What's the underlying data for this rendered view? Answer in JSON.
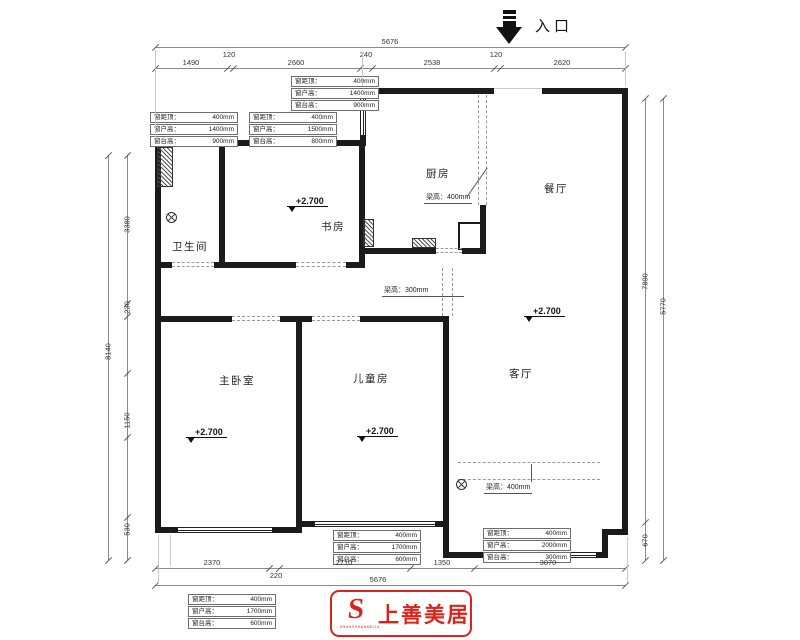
{
  "entrance": {
    "label": "入口"
  },
  "rooms": {
    "bathroom": "卫生间",
    "study": "书房",
    "kitchen": "厨房",
    "dining": "餐厅",
    "master": "主卧室",
    "kids": "儿童房",
    "living": "客厅"
  },
  "level_mark": "+2.700",
  "beams": [
    "梁高：400mm",
    "梁高：300mm",
    "梁高：400mm"
  ],
  "window_boxes": [
    {
      "rows": [
        {
          "k": "窗距顶：",
          "v": "400mm"
        },
        {
          "k": "窗户高：",
          "v": "1400mm"
        },
        {
          "k": "窗台高：",
          "v": "900mm"
        }
      ]
    },
    {
      "rows": [
        {
          "k": "窗距顶：",
          "v": "400mm"
        },
        {
          "k": "窗户高：",
          "v": "1400mm"
        },
        {
          "k": "窗台高：",
          "v": "900mm"
        }
      ]
    },
    {
      "rows": [
        {
          "k": "窗距顶：",
          "v": "400mm"
        },
        {
          "k": "窗户高：",
          "v": "1500mm"
        },
        {
          "k": "窗台高：",
          "v": "800mm"
        }
      ]
    },
    {
      "rows": [
        {
          "k": "窗距顶：",
          "v": "400mm"
        },
        {
          "k": "窗户高：",
          "v": "1700mm"
        },
        {
          "k": "窗台高：",
          "v": "600mm"
        }
      ]
    },
    {
      "rows": [
        {
          "k": "窗距顶：",
          "v": "400mm"
        },
        {
          "k": "窗户高：",
          "v": "2000mm"
        },
        {
          "k": "窗台高：",
          "v": "300mm"
        }
      ]
    },
    {
      "rows": [
        {
          "k": "窗距顶：",
          "v": "400mm"
        },
        {
          "k": "窗户高：",
          "v": "1700mm"
        },
        {
          "k": "窗台高：",
          "v": "600mm"
        }
      ]
    }
  ],
  "dims": {
    "top_total": "5676",
    "top_chain": [
      "1490",
      "120",
      "2660",
      "240",
      "2538",
      "120",
      "2620"
    ],
    "bottom_chain": [
      "2370",
      "220",
      "2710",
      "1350",
      "3070"
    ],
    "bottom_total": "5676",
    "left_outer": "8140",
    "left_chain": [
      "3380",
      "230",
      "1150",
      "530"
    ],
    "right_inner_main": "7890",
    "right_inner_sub": "670",
    "right_outer": "5770"
  },
  "logo": {
    "monogram": "S",
    "sub": "SHANGSHANMEIJU",
    "brand": "上善美居",
    "color": "#d8251c"
  }
}
